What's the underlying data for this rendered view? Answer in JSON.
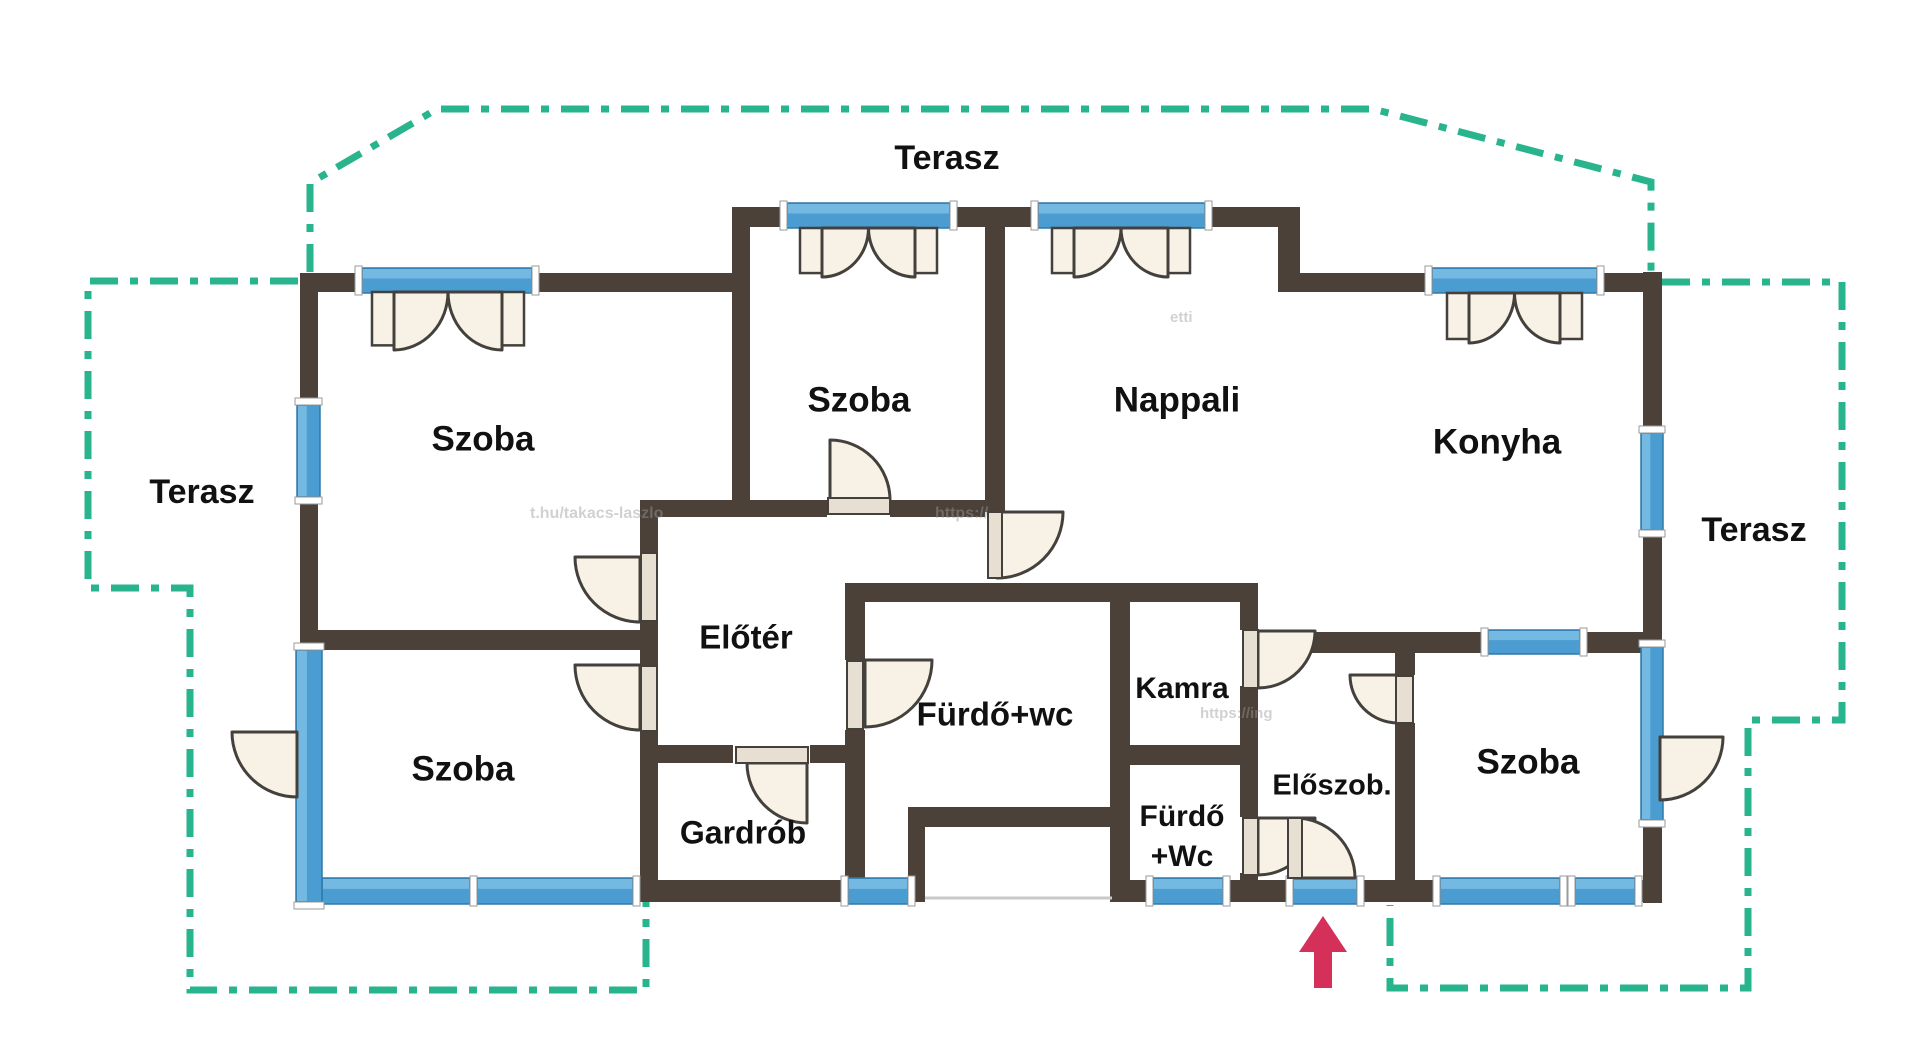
{
  "canvas": {
    "w": 1920,
    "h": 1052
  },
  "palette": {
    "wall": "#4b4139",
    "window": "#4a9cd1",
    "windowLight": "#74b9e2",
    "windowDark": "#2f7aa8",
    "teal": "#28b48d",
    "fan": "#f7f1e6",
    "fanStroke": "#44413c",
    "leaf": "#e7dfd2",
    "cap": "#ffffff",
    "capStroke": "#9a9a9a",
    "arrow": "#d4305a",
    "stepLine": "#c9c9c9",
    "label": "#111111"
  },
  "labels": [
    {
      "id": "label-terasz-top",
      "text": "Terasz",
      "x": 947,
      "y": 160,
      "size": 34
    },
    {
      "id": "label-terasz-left",
      "text": "Terasz",
      "x": 202,
      "y": 494,
      "size": 34
    },
    {
      "id": "label-terasz-right",
      "text": "Terasz",
      "x": 1754,
      "y": 532,
      "size": 34
    },
    {
      "id": "label-szoba-top-left",
      "text": "Szoba",
      "x": 483,
      "y": 441,
      "size": 35
    },
    {
      "id": "label-szoba-middle",
      "text": "Szoba",
      "x": 859,
      "y": 402,
      "size": 35
    },
    {
      "id": "label-nappali",
      "text": "Nappali",
      "x": 1177,
      "y": 402,
      "size": 35
    },
    {
      "id": "label-konyha",
      "text": "Konyha",
      "x": 1497,
      "y": 444,
      "size": 35
    },
    {
      "id": "label-szoba-bottom-left",
      "text": "Szoba",
      "x": 463,
      "y": 771,
      "size": 35
    },
    {
      "id": "label-szoba-right",
      "text": "Szoba",
      "x": 1528,
      "y": 764,
      "size": 35
    },
    {
      "id": "label-eloter",
      "text": "Előtér",
      "x": 746,
      "y": 640,
      "size": 33
    },
    {
      "id": "label-furdo-wc",
      "text": "Fürdő+wc",
      "x": 995,
      "y": 717,
      "size": 33
    },
    {
      "id": "label-kamra",
      "text": "Kamra",
      "x": 1182,
      "y": 690,
      "size": 30
    },
    {
      "id": "label-gardrob",
      "text": "Gardrób",
      "x": 743,
      "y": 835,
      "size": 32
    },
    {
      "id": "label-eloszoba",
      "text": "Előszob.",
      "x": 1332,
      "y": 787,
      "size": 29
    },
    {
      "id": "label-furdo-wc-small-1",
      "text": "Fürdő",
      "x": 1182,
      "y": 818,
      "size": 30
    },
    {
      "id": "label-furdo-wc-small-2",
      "text": "+Wc",
      "x": 1182,
      "y": 858,
      "size": 30
    }
  ],
  "walls": [
    [
      300,
      273,
      62,
      19
    ],
    [
      532,
      273,
      218,
      19
    ],
    [
      732,
      207,
      55,
      20
    ],
    [
      950,
      207,
      88,
      20
    ],
    [
      1205,
      207,
      95,
      20
    ],
    [
      1278,
      207,
      22,
      85
    ],
    [
      1300,
      273,
      132,
      19
    ],
    [
      1597,
      273,
      63,
      19
    ],
    [
      1643,
      272,
      19,
      161
    ],
    [
      1643,
      530,
      19,
      117
    ],
    [
      1643,
      820,
      19,
      83
    ],
    [
      300,
      273,
      18,
      377
    ],
    [
      300,
      630,
      358,
      20
    ],
    [
      732,
      227,
      18,
      275
    ],
    [
      640,
      500,
      187,
      17
    ],
    [
      890,
      500,
      95,
      17
    ],
    [
      640,
      517,
      18,
      35
    ],
    [
      640,
      622,
      18,
      28
    ],
    [
      640,
      650,
      18,
      15
    ],
    [
      640,
      732,
      18,
      148
    ],
    [
      985,
      227,
      20,
      285
    ],
    [
      845,
      583,
      413,
      19
    ],
    [
      845,
      602,
      20,
      58
    ],
    [
      845,
      730,
      20,
      172
    ],
    [
      657,
      745,
      76,
      18
    ],
    [
      810,
      745,
      35,
      18
    ],
    [
      1110,
      602,
      20,
      300
    ],
    [
      1110,
      745,
      148,
      20
    ],
    [
      1240,
      583,
      18,
      47
    ],
    [
      1240,
      686,
      18,
      131
    ],
    [
      1240,
      873,
      18,
      29
    ],
    [
      1258,
      632,
      230,
      21
    ],
    [
      1580,
      632,
      80,
      21
    ],
    [
      1395,
      653,
      20,
      22
    ],
    [
      1395,
      723,
      20,
      179
    ],
    [
      633,
      880,
      215,
      22
    ],
    [
      908,
      880,
      17,
      22
    ],
    [
      908,
      807,
      17,
      95
    ],
    [
      908,
      807,
      204,
      20
    ],
    [
      1130,
      880,
      23,
      22
    ],
    [
      1223,
      880,
      70,
      22
    ],
    [
      1357,
      880,
      83,
      22
    ],
    [
      1560,
      880,
      15,
      22
    ],
    [
      1635,
      880,
      25,
      22
    ]
  ],
  "windows": [
    {
      "id": "window-szoba-top-left",
      "x": 362,
      "y": 268,
      "w": 170,
      "h": 25,
      "o": "h"
    },
    {
      "id": "window-szoba-left-wall",
      "x": 297,
      "y": 405,
      "w": 23,
      "h": 92,
      "o": "v"
    },
    {
      "id": "window-szoba-middle",
      "x": 787,
      "y": 203,
      "w": 163,
      "h": 25,
      "o": "h"
    },
    {
      "id": "window-nappali",
      "x": 1038,
      "y": 203,
      "w": 167,
      "h": 25,
      "o": "h"
    },
    {
      "id": "window-konyha",
      "x": 1432,
      "y": 268,
      "w": 165,
      "h": 25,
      "o": "h"
    },
    {
      "id": "window-right-wall-upper",
      "x": 1641,
      "y": 433,
      "w": 22,
      "h": 97,
      "o": "v"
    },
    {
      "id": "window-door-right-wall",
      "x": 1641,
      "y": 647,
      "w": 22,
      "h": 173,
      "o": "v"
    },
    {
      "id": "window-konyha-szoba",
      "x": 1488,
      "y": 630,
      "w": 92,
      "h": 24,
      "o": "h"
    },
    {
      "id": "window-szoba-bottom-1",
      "x": 322,
      "y": 878,
      "w": 148,
      "h": 26,
      "o": "h"
    },
    {
      "id": "window-szoba-bottom-2",
      "x": 477,
      "y": 878,
      "w": 156,
      "h": 26,
      "o": "h"
    },
    {
      "id": "window-west-wall-glazed",
      "x": 296,
      "y": 650,
      "w": 26,
      "h": 252,
      "o": "v"
    },
    {
      "id": "window-middle-bottom",
      "x": 848,
      "y": 878,
      "w": 60,
      "h": 26,
      "o": "h"
    },
    {
      "id": "window-furdo-wc-small",
      "x": 1153,
      "y": 878,
      "w": 70,
      "h": 26,
      "o": "h"
    },
    {
      "id": "window-entrance-door",
      "x": 1293,
      "y": 878,
      "w": 64,
      "h": 26,
      "o": "h"
    },
    {
      "id": "window-szoba-right-bottom-1",
      "x": 1440,
      "y": 878,
      "w": 120,
      "h": 26,
      "o": "h"
    },
    {
      "id": "window-szoba-right-bottom-2",
      "x": 1575,
      "y": 878,
      "w": 60,
      "h": 26,
      "o": "h"
    }
  ],
  "doors": [
    {
      "id": "door-szoba-middle",
      "d": "M830,500 L830,440 A60,60 0 0 1 890,500 Z"
    },
    {
      "id": "door-nappali",
      "d": "M997,512 L997,578 A66,66 0 0 0 1063,512 Z"
    },
    {
      "id": "door-szoba-top-left",
      "d": "M640,557 L640,622 A65,65 0 0 1 575,557 Z"
    },
    {
      "id": "door-szoba-bottom-left",
      "d": "M640,665 L640,730 A65,65 0 0 1 575,665 Z"
    },
    {
      "id": "door-gardrob",
      "d": "M807,763 L747,763 A60,60 0 0 0 807,823 Z"
    },
    {
      "id": "door-furdo-wc",
      "d": "M865,660 L865,727 A67,67 0 0 0 932,660 Z"
    },
    {
      "id": "door-kamra",
      "d": "M1258,631 L1258,688 A57,57 0 0 0 1315,631 Z"
    },
    {
      "id": "door-furdo-wc-small",
      "d": "M1258,818 L1258,875 A57,57 0 0 0 1315,818 Z"
    },
    {
      "id": "door-entrance",
      "d": "M1295,878 L1295,818 A60,60 0 0 1 1355,878 Z"
    },
    {
      "id": "door-szoba-right",
      "d": "M1398,675 L1398,723 A48,48 0 0 1 1350,675 Z"
    },
    {
      "id": "door-terrace-right",
      "d": "M1660,737 L1660,800 A63,63 0 0 0 1723,737 Z"
    },
    {
      "id": "door-terrace-west",
      "d": "M297,732 L297,797 A65,65 0 0 1 232,732 Z"
    }
  ],
  "leaves": [
    [
      828,
      498,
      62,
      16
    ],
    [
      988,
      512,
      14,
      66
    ],
    [
      641,
      553,
      16,
      68
    ],
    [
      641,
      666,
      16,
      65
    ],
    [
      736,
      747,
      72,
      16
    ],
    [
      847,
      661,
      16,
      68
    ],
    [
      1243,
      630,
      15,
      58
    ],
    [
      1243,
      818,
      15,
      57
    ],
    [
      1288,
      818,
      14,
      60
    ],
    [
      1396,
      676,
      17,
      47
    ]
  ],
  "curtains": [
    {
      "id": "curtain-szoba-top-left",
      "x1": 372,
      "x2": 524,
      "y": 292,
      "h": 58
    },
    {
      "id": "curtain-szoba-middle",
      "x1": 800,
      "x2": 937,
      "y": 228,
      "h": 49
    },
    {
      "id": "curtain-nappali",
      "x1": 1052,
      "x2": 1190,
      "y": 228,
      "h": 49
    },
    {
      "id": "curtain-konyha",
      "x1": 1447,
      "x2": 1582,
      "y": 293,
      "h": 50
    }
  ],
  "terrace_outline": [
    {
      "id": "terrace-left-outline",
      "d": "M298,281 L88,281 L88,588 L190,588 L190,990 L646,990 L646,902"
    },
    {
      "id": "terrace-top-outline",
      "d": "M310,272 L310,183 L437,109 L1373,109 L1651,182 L1651,272"
    },
    {
      "id": "terrace-right-outline",
      "d": "M1662,282 L1842,282 L1842,720 L1748,720 L1748,988 L1390,988 L1390,905"
    }
  ],
  "entrance_arrow": {
    "head": "1323,916 1299,952 1347,952",
    "stem": [
      1314,
      950,
      18,
      38
    ]
  },
  "step_line": {
    "x1": 925,
    "y1": 898,
    "x2": 1112,
    "y2": 898
  },
  "watermarks": [
    {
      "text": "t.hu/takacs-laszlo",
      "x": 530,
      "y": 518,
      "size": 16
    },
    {
      "text": "https://",
      "x": 935,
      "y": 518,
      "size": 16
    },
    {
      "text": "etti",
      "x": 1170,
      "y": 322,
      "size": 15
    },
    {
      "text": "https://ing",
      "x": 1200,
      "y": 718,
      "size": 15
    }
  ]
}
